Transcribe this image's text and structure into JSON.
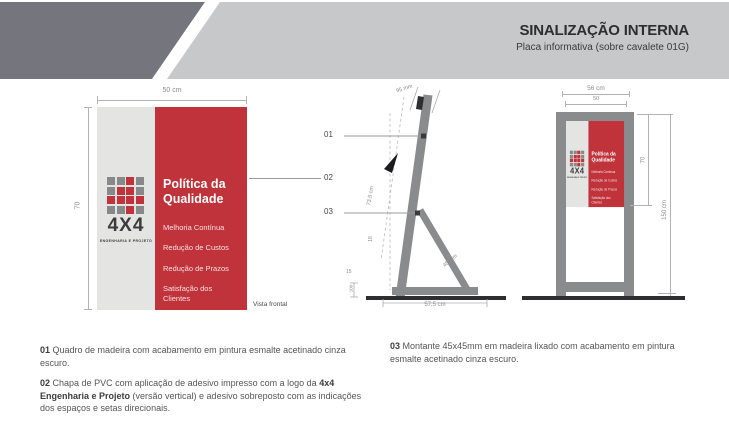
{
  "header": {
    "title": "SINALIZAÇÃO INTERNA",
    "subtitle": "Placa informativa (sobre cavalete 01G)"
  },
  "placard": {
    "heading": "Política da Qualidade",
    "items": [
      "Melhoria Contínua",
      "Redução de Custos",
      "Redução de Prazos",
      "Satisfação dos Clientes"
    ],
    "logo": {
      "wordmark": "4X4",
      "tagline": "ENGENHARIA E PROJETO",
      "grid": [
        [
          "g",
          "g",
          "r",
          "g"
        ],
        [
          "g",
          "r",
          "r",
          "g"
        ],
        [
          "r",
          "r",
          "r",
          "r"
        ],
        [
          "g",
          "g",
          "r",
          "g"
        ]
      ]
    }
  },
  "front_view": {
    "width_dim": "50 cm",
    "height_dim": "70",
    "caption": "Vista frontal"
  },
  "side_view": {
    "callout_01": "01",
    "callout_02": "02",
    "callout_03": "03",
    "dim_top": "95 mm",
    "dim_board_length": "73,5 cm",
    "dim_upper": "18",
    "dim_lower": "15",
    "dim_foot": "100",
    "dim_leg": "45 mm",
    "dim_base": "57,5 cm"
  },
  "mounted_view": {
    "dim_outer_width": "56 cm",
    "dim_inner_width": "50",
    "dim_placard_height": "70",
    "dim_total_height": "150 cm"
  },
  "notes": {
    "n1": {
      "num": "01",
      "text": "Quadro de madeira com acabamento em pintura esmalte acetinado cinza escuro."
    },
    "n2": {
      "num": "02",
      "text_before": "Chapa de PVC com aplicação de adesivo impresso com a logo da ",
      "text_bold": "4x4 Engenharia e Projeto",
      "text_after": " (versão vertical) e adesivo sobreposto com as indicações dos espaços e setas direcionais."
    },
    "n3": {
      "num": "03",
      "text": "Montante 45x45mm em madeira lixado com acabamento em pintura esmalte acetinado cinza escuro."
    }
  },
  "colors": {
    "header_dark": "#75757d",
    "header_light": "#c7c8ca",
    "red": "#c0333a",
    "placard_gray": "#e4e4e3",
    "logo_gray": "#87888a",
    "logo_red": "#c0333a",
    "frame_gray": "#8a8b8d",
    "ground_dark": "#2e2e30",
    "dim_gray": "#9b9b9d",
    "text_dark": "#3b3b3d",
    "note_text": "#565658"
  }
}
